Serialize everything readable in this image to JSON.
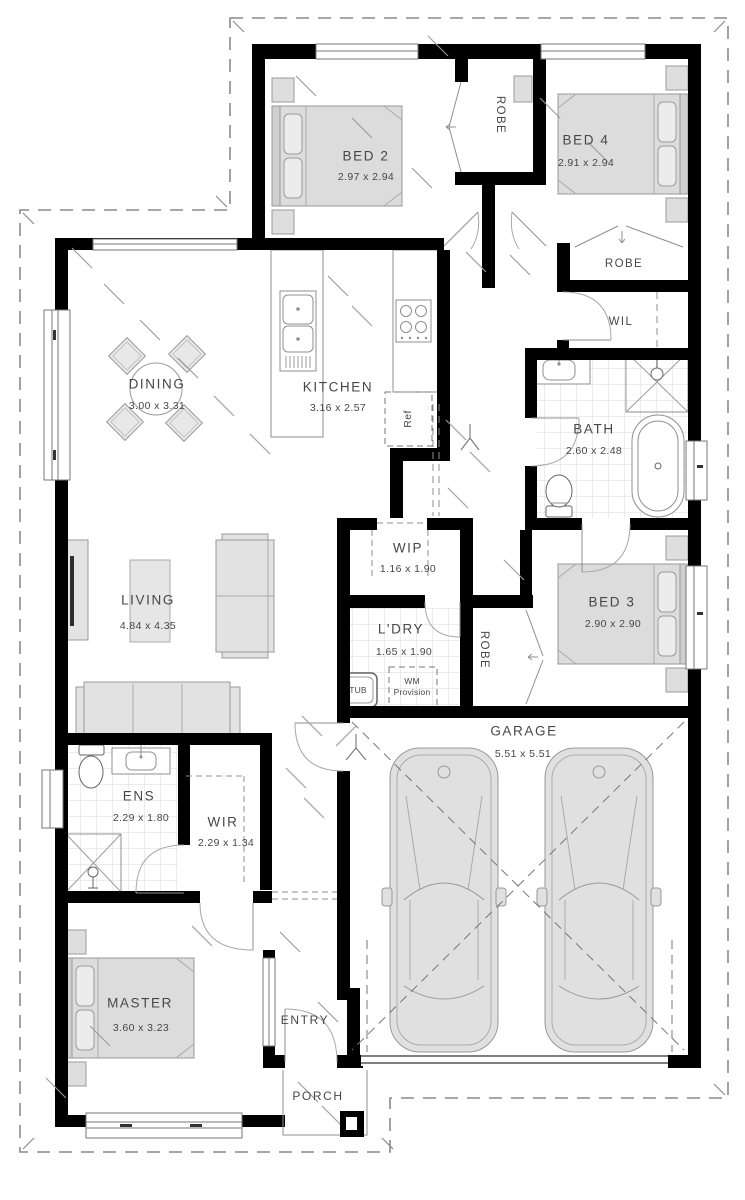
{
  "title": "Single storey house floor plan",
  "rooms": {
    "bed2": {
      "name": "BED 2",
      "dims": "2.97 x 2.94"
    },
    "bed4": {
      "name": "BED 4",
      "dims": "2.91 x 2.94"
    },
    "bed3": {
      "name": "BED 3",
      "dims": "2.90 x 2.90"
    },
    "master": {
      "name": "MASTER",
      "dims": "3.60 x 3.23"
    },
    "dining": {
      "name": "DINING",
      "dims": "3.00 x 3.31"
    },
    "kitchen": {
      "name": "KITCHEN",
      "dims": "3.16 x 2.57"
    },
    "living": {
      "name": "LIVING",
      "dims": "4.84 x 4.35"
    },
    "bath": {
      "name": "BATH",
      "dims": "2.60 x 2.48"
    },
    "wip": {
      "name": "WIP",
      "dims": "1.16 x 1.90"
    },
    "ldry": {
      "name": "L'DRY",
      "dims": "1.65 x 1.90"
    },
    "ens": {
      "name": "ENS",
      "dims": "2.29 x 1.80"
    },
    "wir": {
      "name": "WIR",
      "dims": "2.29 x 1.34"
    },
    "garage": {
      "name": "GARAGE",
      "dims": "5.51 x 5.51"
    }
  },
  "labels": {
    "robe_bed2": "ROBE",
    "robe_bed4": "ROBE",
    "robe_bed3": "ROBE",
    "wil": "WIL",
    "ref": "Ref",
    "tub": "TUB",
    "wm_line1": "WM",
    "wm_line2": "Provision",
    "entry": "ENTRY",
    "porch": "PORCH"
  },
  "colors": {
    "wall": "#000000",
    "furniture_fill": "#dedede",
    "line": "#8f8f8f",
    "text": "#474747",
    "tile": "#d9d9d9"
  }
}
